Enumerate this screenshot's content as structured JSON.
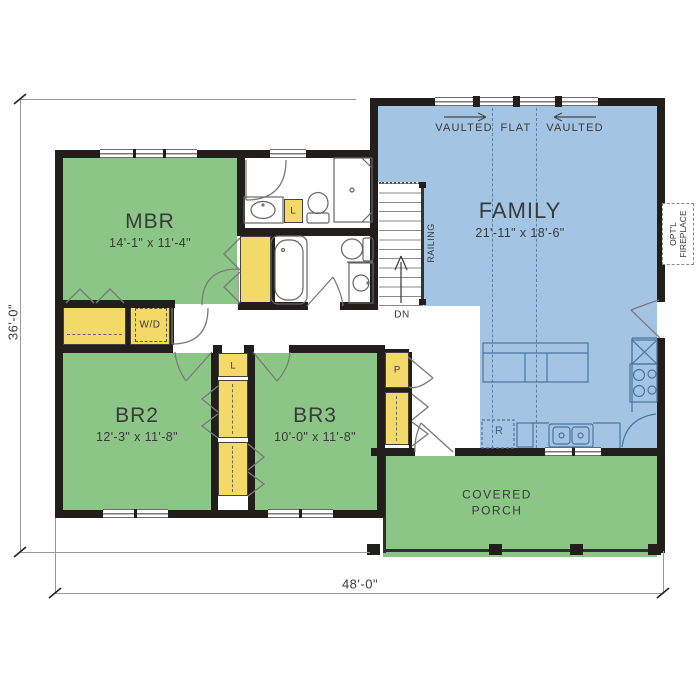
{
  "plan_type": "single-story house floor plan",
  "overall": {
    "width_label": "48'-0\"",
    "depth_label": "36'-0\""
  },
  "rooms": {
    "mbr": {
      "name": "MBR",
      "dims": "14'-1\" x 11'-4\""
    },
    "br2": {
      "name": "BR2",
      "dims": "12'-3\" x 11'-8\""
    },
    "br3": {
      "name": "BR3",
      "dims": "10'-0\" x 11'-8\""
    },
    "family": {
      "name": "FAMILY",
      "dims": "21'-11\" x 18'-6\""
    },
    "porch": {
      "name": "COVERED PORCH"
    }
  },
  "ceiling": {
    "left": "VAULTED",
    "center": "FLAT",
    "right": "VAULTED"
  },
  "stairs": {
    "railing_label": "RAILING",
    "direction_label": "DN"
  },
  "labels": {
    "washer_dryer": "W/D",
    "linen_hall": "L",
    "linen_bath": "L",
    "pantry": "P",
    "refrigerator": "R",
    "fireplace": "OPT'L FIREPLACE"
  },
  "colors": {
    "bedroom_green": "#8cc687",
    "porch_green": "#8cc687",
    "family_blue": "#a3c5e3",
    "closet_yellow": "#f3d967",
    "wall": "#211e1c"
  }
}
